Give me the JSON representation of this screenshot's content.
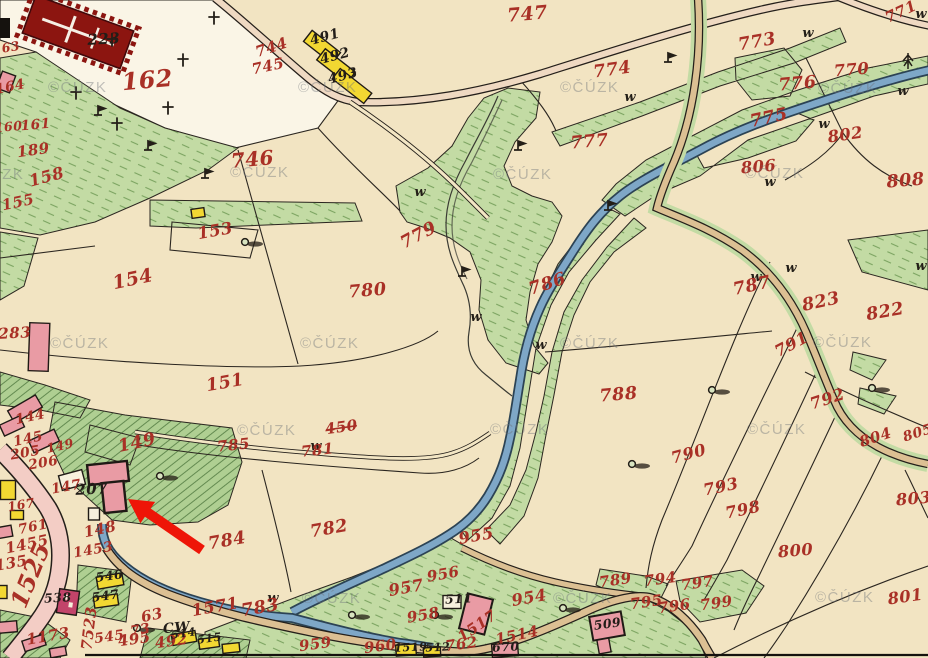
{
  "map": {
    "description": "Historical cadastral map scan (archival imperial map sheet) with red handwritten parcel numbers, stream, roads, village buildings and a red locator arrow",
    "watermark": {
      "text": "©ČÚZK",
      "positions": [
        [
          48,
          87
        ],
        [
          298,
          87
        ],
        [
          560,
          87
        ],
        [
          818,
          88
        ],
        [
          -35,
          174
        ],
        [
          230,
          172
        ],
        [
          493,
          174
        ],
        [
          745,
          173
        ],
        [
          50,
          343
        ],
        [
          300,
          343
        ],
        [
          560,
          343
        ],
        [
          813,
          342
        ],
        [
          237,
          430
        ],
        [
          490,
          429
        ],
        [
          747,
          429
        ],
        [
          302,
          598
        ],
        [
          553,
          598
        ],
        [
          815,
          597
        ]
      ]
    },
    "parcel_labels": [
      [
        "162",
        148,
        88,
        19,
        -5
      ],
      [
        "223",
        104,
        44,
        12,
        -3,
        "b"
      ],
      [
        "746",
        253,
        166,
        16,
        -5
      ],
      [
        "744",
        273,
        52,
        12,
        -18
      ],
      [
        "745",
        269,
        71,
        12,
        -12
      ],
      [
        "491",
        326,
        41,
        11,
        -15,
        "b"
      ],
      [
        "492",
        336,
        60,
        11,
        -15,
        "b"
      ],
      [
        "493",
        344,
        80,
        11,
        -15,
        "b"
      ],
      [
        "747",
        528,
        20,
        15,
        -5
      ],
      [
        "773",
        758,
        47,
        14,
        -10
      ],
      [
        "774",
        613,
        75,
        14,
        -8
      ],
      [
        "771",
        903,
        16,
        12,
        -25
      ],
      [
        "770",
        852,
        75,
        13,
        -5
      ],
      [
        "776",
        798,
        89,
        14,
        -5
      ],
      [
        "775",
        770,
        123,
        14,
        -12
      ],
      [
        "777",
        590,
        147,
        14,
        -5
      ],
      [
        "802",
        846,
        140,
        13,
        -8
      ],
      [
        "806",
        759,
        172,
        13,
        -5
      ],
      [
        "808",
        906,
        186,
        14,
        -5
      ],
      [
        "803",
        914,
        504,
        13,
        -5
      ],
      [
        "804",
        877,
        442,
        12,
        -18
      ],
      [
        "805",
        919,
        437,
        11,
        -18
      ],
      [
        "822",
        886,
        317,
        14,
        -10
      ],
      [
        "823",
        822,
        307,
        14,
        -12
      ],
      [
        "787",
        753,
        291,
        14,
        -12
      ],
      [
        "791",
        794,
        349,
        13,
        -28
      ],
      [
        "792",
        829,
        404,
        13,
        -18
      ],
      [
        "779",
        421,
        240,
        14,
        -28
      ],
      [
        "780",
        368,
        296,
        14,
        -5
      ],
      [
        "786",
        549,
        289,
        14,
        -18
      ],
      [
        "788",
        619,
        400,
        14,
        -5
      ],
      [
        "790",
        690,
        459,
        13,
        -15
      ],
      [
        "793",
        722,
        492,
        13,
        -12
      ],
      [
        "798",
        744,
        515,
        13,
        -12
      ],
      [
        "800",
        796,
        556,
        13,
        -5
      ],
      [
        "801",
        906,
        602,
        13,
        -8
      ],
      [
        "797",
        698,
        588,
        12,
        -8
      ],
      [
        "799",
        717,
        608,
        12,
        -8
      ],
      [
        "794",
        661,
        584,
        12,
        -8
      ],
      [
        "795",
        647,
        607,
        12,
        -8
      ],
      [
        "796",
        675,
        611,
        12,
        -8
      ],
      [
        "789",
        616,
        585,
        12,
        -8
      ],
      [
        "163",
        7,
        52,
        10,
        -10
      ],
      [
        "164",
        11,
        91,
        11,
        -12
      ],
      [
        "160",
        9,
        131,
        10,
        -5
      ],
      [
        "161",
        36,
        129,
        11,
        -5
      ],
      [
        "189",
        34,
        155,
        12,
        -8
      ],
      [
        "158",
        48,
        182,
        13,
        -15
      ],
      [
        "155",
        19,
        207,
        12,
        -12
      ],
      [
        "153",
        216,
        236,
        13,
        -10
      ],
      [
        "154",
        134,
        285,
        15,
        -12
      ],
      [
        "151",
        226,
        388,
        14,
        -10
      ],
      [
        "283",
        15,
        338,
        12,
        -3
      ],
      [
        "149",
        138,
        448,
        14,
        -12
      ],
      [
        "149",
        61,
        450,
        10,
        -12
      ],
      [
        "144",
        31,
        421,
        11,
        -12
      ],
      [
        "145",
        29,
        443,
        11,
        -12
      ],
      [
        "205",
        26,
        457,
        11,
        -10
      ],
      [
        "206",
        44,
        467,
        11,
        -10
      ],
      [
        "147",
        67,
        491,
        11,
        -10
      ],
      [
        "207",
        92,
        494,
        12,
        -3,
        "b"
      ],
      [
        "148",
        101,
        534,
        12,
        -12
      ],
      [
        "1453",
        94,
        554,
        11,
        -10
      ],
      [
        "1455",
        28,
        549,
        12,
        -12
      ],
      [
        "135",
        12,
        568,
        12,
        -10
      ],
      [
        "761",
        34,
        531,
        11,
        -12
      ],
      [
        "167",
        22,
        509,
        10,
        -10
      ],
      [
        "1525",
        38,
        578,
        19,
        -68
      ],
      [
        "1173",
        49,
        641,
        12,
        -10
      ],
      [
        "63",
        153,
        620,
        12,
        -12
      ],
      [
        "73",
        141,
        634,
        11,
        -10
      ],
      [
        "CW",
        177,
        632,
        11,
        -5,
        "b"
      ],
      [
        "7523",
        94,
        629,
        12,
        -83
      ],
      [
        "545",
        110,
        641,
        11,
        -8
      ],
      [
        "495",
        135,
        644,
        12,
        -8
      ],
      [
        "492",
        172,
        646,
        12,
        -8
      ],
      [
        "1571",
        216,
        612,
        13,
        -10
      ],
      [
        "783",
        261,
        613,
        14,
        -10
      ],
      [
        "784",
        228,
        546,
        14,
        -10
      ],
      [
        "782",
        330,
        534,
        14,
        -10
      ],
      [
        "785",
        234,
        450,
        12,
        -6
      ],
      [
        "781",
        318,
        455,
        12,
        -6
      ],
      [
        "450",
        342,
        432,
        12,
        -8,
        "",
        1
      ],
      [
        "955",
        477,
        541,
        13,
        -10
      ],
      [
        "956",
        444,
        579,
        12,
        -10
      ],
      [
        "957",
        407,
        593,
        13,
        -10
      ],
      [
        "958",
        424,
        620,
        12,
        -10
      ],
      [
        "954",
        530,
        603,
        13,
        -10
      ],
      [
        "959",
        316,
        649,
        12,
        -8
      ],
      [
        "960",
        381,
        651,
        12,
        -8
      ],
      [
        "762",
        462,
        649,
        12,
        -8
      ],
      [
        "1517",
        480,
        630,
        12,
        -35
      ],
      [
        "1514",
        518,
        640,
        12,
        -12
      ],
      [
        "538",
        58,
        602,
        10,
        -3,
        "b"
      ],
      [
        "546",
        110,
        580,
        10,
        -8,
        "b"
      ],
      [
        "547",
        106,
        600,
        10,
        -8,
        "b"
      ],
      [
        "511",
        459,
        603,
        10,
        -3,
        "b"
      ],
      [
        "509",
        608,
        628,
        10,
        -8,
        "b"
      ],
      [
        "670",
        506,
        651,
        10,
        -3,
        "b"
      ],
      [
        "514",
        184,
        637,
        9,
        -8,
        "b"
      ],
      [
        "515",
        210,
        642,
        9,
        -8,
        "b"
      ],
      [
        "512",
        438,
        651,
        9,
        -3,
        "b"
      ],
      [
        "1519",
        411,
        651,
        9,
        -3,
        "b"
      ]
    ],
    "symbols": {
      "w": [
        [
          420,
          192
        ],
        [
          476,
          317
        ],
        [
          541,
          345
        ],
        [
          630,
          97
        ],
        [
          808,
          33
        ],
        [
          921,
          14
        ],
        [
          903,
          91
        ],
        [
          824,
          124
        ],
        [
          770,
          182
        ],
        [
          756,
          277
        ],
        [
          791,
          268
        ],
        [
          921,
          266
        ],
        [
          316,
          446
        ],
        [
          273,
          598
        ]
      ],
      "t": [
        [
          112,
          42
        ],
        [
          183,
          62
        ],
        [
          214,
          20
        ],
        [
          168,
          110
        ],
        [
          117,
          126
        ],
        [
          76,
          95
        ]
      ],
      "flag": [
        [
          98,
          115
        ],
        [
          148,
          150
        ],
        [
          205,
          178
        ],
        [
          518,
          150
        ],
        [
          462,
          276
        ],
        [
          668,
          62
        ],
        [
          608,
          210
        ]
      ],
      "tree": [
        [
          245,
          242
        ],
        [
          712,
          390
        ],
        [
          872,
          388
        ],
        [
          632,
          464
        ],
        [
          563,
          608
        ],
        [
          352,
          615
        ],
        [
          435,
          615
        ],
        [
          137,
          628
        ],
        [
          160,
          476
        ]
      ],
      "conifer": [
        [
          908,
          62
        ]
      ]
    },
    "arrow": {
      "tail": [
        202,
        550
      ],
      "head": [
        128,
        499
      ],
      "color": "#ee1507"
    },
    "colors": {
      "paper": "#f2e4c2",
      "paper_light": "#faf5e6",
      "meadow": "#c3dba4",
      "garden": "#afcf92",
      "river": "#7ea7c7",
      "river_edge": "#2c4354",
      "road_tan": "#dcc093",
      "road_pale": "#efd9c2",
      "road_pink": "#f3cdc5",
      "building_pink": "#e99ba4",
      "building_yellow": "#f2d832",
      "building_red": "#8c1510",
      "building_magenta": "#c2446a",
      "label_red": "#a93026",
      "label_black": "#221d18",
      "line": "#2b2620"
    }
  }
}
